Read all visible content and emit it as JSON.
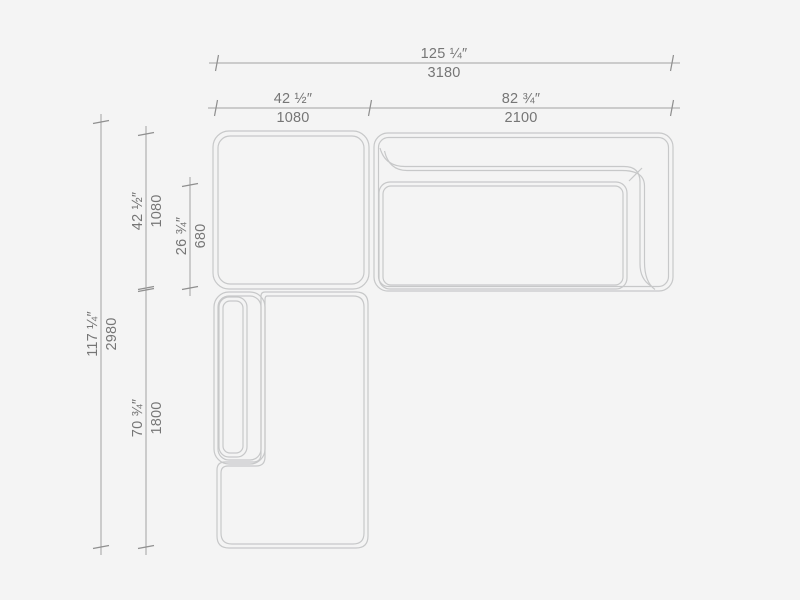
{
  "drawing": {
    "title": "sectional-sofa-plan-view",
    "colors": {
      "background": "#f4f4f4",
      "furniture_line": "#c7c8c9",
      "dimension_line": "#a2a2a2",
      "label_text": "#767676"
    }
  },
  "dimensions": {
    "overall_width": {
      "inches": "125 ¼″",
      "mm": "3180"
    },
    "ottoman_width": {
      "inches": "42 ½″",
      "mm": "1080"
    },
    "sofa_width": {
      "inches": "82 ¾″",
      "mm": "2100"
    },
    "overall_depth": {
      "inches": "117 ¼″",
      "mm": "2980"
    },
    "ottoman_depth": {
      "inches": "42 ½″",
      "mm": "1080"
    },
    "seat_depth": {
      "inches": "26 ¾″",
      "mm": "680"
    },
    "chaise_length": {
      "inches": "70 ¾″",
      "mm": "1800"
    }
  }
}
